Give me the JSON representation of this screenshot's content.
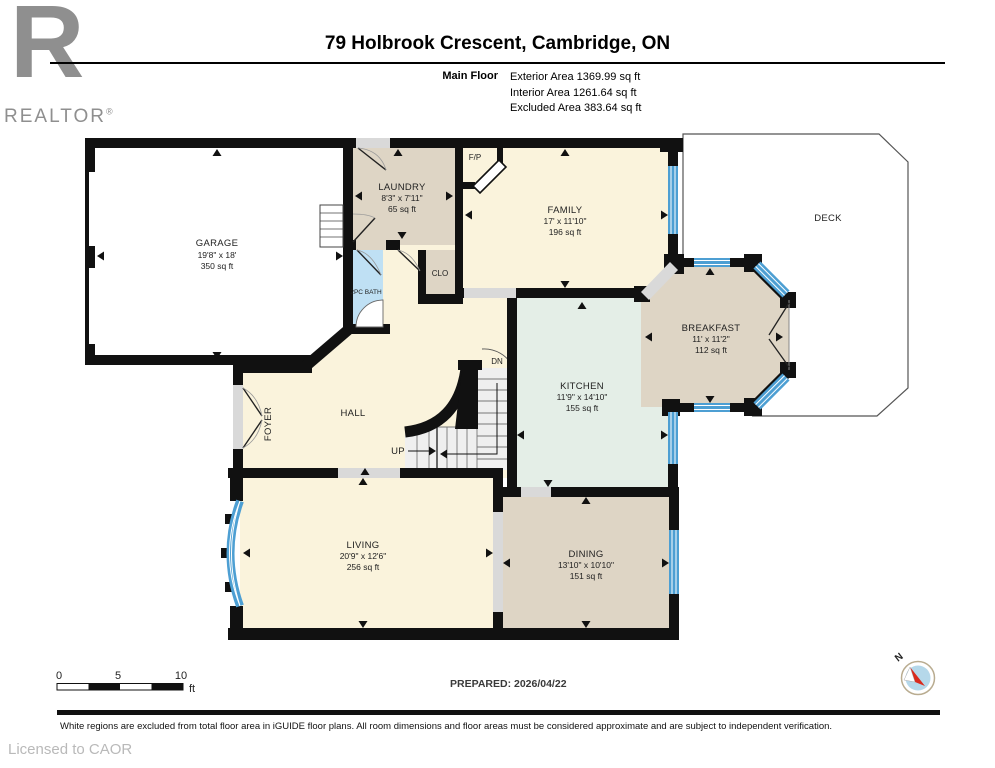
{
  "header": {
    "title": "79 Holbrook Crescent, Cambridge, ON",
    "floor": "Main Floor",
    "exterior": "Exterior Area 1369.99 sq ft",
    "interior": "Interior Area 1261.64 sq ft",
    "excluded": "Excluded Area 383.64 sq ft"
  },
  "logo": {
    "letter": "R",
    "wordmark": "REALTOR",
    "reg": "®"
  },
  "rooms": {
    "garage": {
      "name": "GARAGE",
      "dims": "19'8\" x 18'",
      "area": "350 sq ft"
    },
    "laundry": {
      "name": "LAUNDRY",
      "dims": "8'3\" x 7'11\"",
      "area": "65 sq ft"
    },
    "family": {
      "name": "FAMILY",
      "dims": "17' x 11'10\"",
      "area": "196 sq ft"
    },
    "breakfast": {
      "name": "BREAKFAST",
      "dims": "11' x 11'2\"",
      "area": "112 sq ft"
    },
    "kitchen": {
      "name": "KITCHEN",
      "dims": "11'9\" x 14'10\"",
      "area": "155 sq ft"
    },
    "living": {
      "name": "LIVING",
      "dims": "20'9\" x 12'6\"",
      "area": "256 sq ft"
    },
    "dining": {
      "name": "DINING",
      "dims": "13'10\" x 10'10\"",
      "area": "151 sq ft"
    },
    "deck": {
      "name": "DECK"
    },
    "hall": {
      "name": "HALL"
    },
    "foyer": {
      "name": "FOYER"
    },
    "bath": {
      "name": "2PC BATH"
    },
    "closet": {
      "name": "CLO"
    },
    "fireplace": {
      "name": "F/P"
    }
  },
  "stairs": {
    "up": "UP",
    "down": "DN"
  },
  "scale": {
    "t0": "0",
    "t5": "5",
    "t10": "10",
    "unit": "ft"
  },
  "prepared": "PREPARED: 2026/04/22",
  "compass": {
    "north": "N"
  },
  "footer": {
    "disclaimer": "White regions are excluded from total floor area in iGUIDE floor plans. All room dimensions and floor areas must be considered approximate and are subject to independent verification.",
    "license": "Licensed to CAOR"
  },
  "colors": {
    "wall": "#111111",
    "window": "#4d9fd3",
    "cream": "#faf3dc",
    "tan": "#ded5c5",
    "mint": "#e4eee7",
    "bath_blue": "#bfe0f4",
    "opening": "#d9d9d9"
  }
}
